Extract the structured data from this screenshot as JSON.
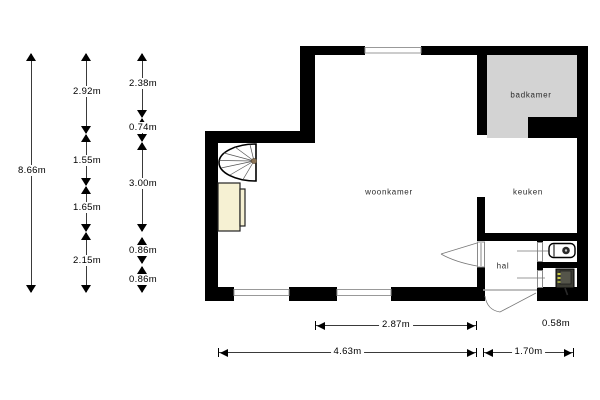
{
  "title": "floorplan",
  "rooms": {
    "woonkamer": "woonkamer",
    "keuken": "keuken",
    "badkamer": "badkamer",
    "hal": "hal"
  },
  "dims": {
    "v1": [
      "8.66m"
    ],
    "v2": [
      "2.92m",
      "1.55m",
      "1.65m",
      "2.15m"
    ],
    "v3": [
      "2.38m",
      "0.74m",
      "3.00m",
      "0.86m",
      "0.86m"
    ],
    "h": [
      "2.87m",
      "0.58m",
      "4.63m",
      "1.70m"
    ]
  },
  "icons": {
    "staircase": "spiral-staircase-icon",
    "boiler": "boiler-icon",
    "meter": "electrical-meter-icon",
    "doors": "door-swing-icon",
    "windows": "window-icon"
  },
  "colors": {
    "wall": "#000000",
    "badkamer_fill": "#d3d3d3",
    "furniture_fill": "#f6f1d3",
    "window_line": "#999999",
    "dimension_line": "#3a3a3a",
    "text": "#2a2a2a",
    "stair_hub": "#8b7355",
    "background": "#ffffff"
  }
}
